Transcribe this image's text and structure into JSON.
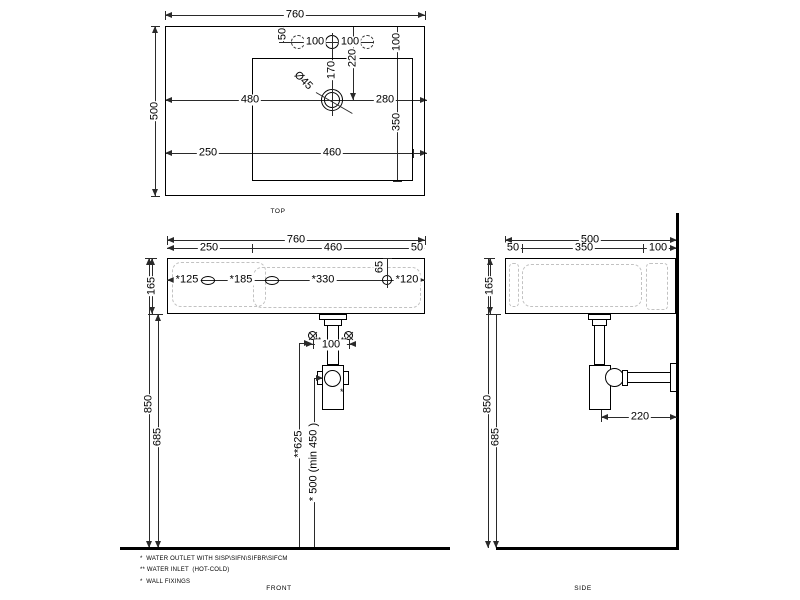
{
  "top": {
    "width": "760",
    "depth": "500",
    "tap_offset": "50",
    "pitch_l": "100",
    "pitch_r": "100",
    "deck": "100",
    "front_to_drain": "220",
    "tap_to_drain": "170",
    "drain_dia": "Ø45",
    "drain_from_left": "480",
    "drain_from_right": "280",
    "bowl_depth": "350",
    "bowl_offset_left": "250",
    "bowl_width": "460",
    "caption": "TOP"
  },
  "front": {
    "width": "760",
    "seg_left": "250",
    "seg_mid": "460",
    "seg_right": "50",
    "height": "165",
    "fix1": "*125",
    "fix2": "*185",
    "fix3": "*330",
    "fix4": "*120",
    "fix_drop": "65",
    "inlet_mark": "**",
    "inlet_pitch": "100",
    "floor_to_rim": "850",
    "floor_to_bottom": "685",
    "floor_to_inlet": "**625",
    "floor_to_outlet": "* 500 (min 450 )",
    "outlet_mark": "*",
    "caption": "FRONT"
  },
  "side": {
    "depth": "500",
    "seg_front": "50",
    "seg_mid": "350",
    "seg_rear": "100",
    "height": "165",
    "floor_to_rim": "850",
    "floor_to_bottom": "685",
    "trap_to_wall": "220",
    "caption": "SIDE"
  },
  "notes": {
    "outlet": "*  WATER OUTLET WITH SISP\\SIFN\\SIFBR\\SIFCM",
    "inlet": "** WATER INLET  (HOT-COLD)",
    "fixings": "*  WALL FIXINGS"
  },
  "colors": {
    "line": "#000000",
    "dim": "#2a2a2a",
    "hidden": "#c2c2c2",
    "bg": "#ffffff"
  }
}
